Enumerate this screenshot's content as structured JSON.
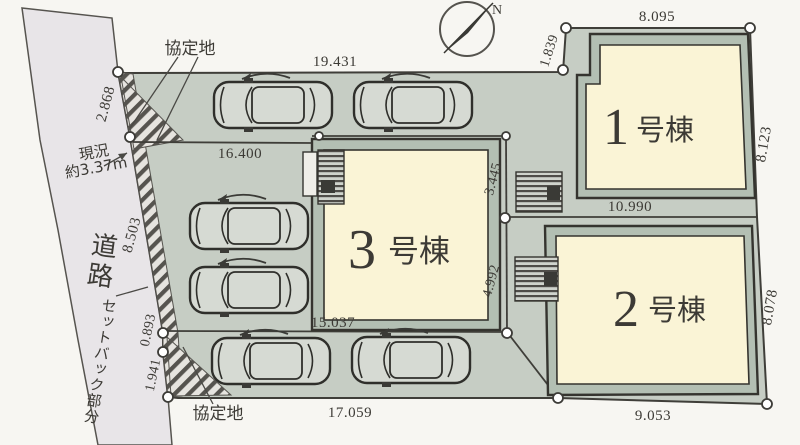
{
  "compass": {
    "north_label": "N"
  },
  "road": {
    "name": "道路",
    "width_note_line1": "現況",
    "width_note_line2": "約3.37m",
    "setback_label": "セットバック部分"
  },
  "agreement_area": {
    "top_label": "協定地",
    "bottom_label": "協定地"
  },
  "buildings": [
    {
      "number": "1",
      "suffix": "号棟"
    },
    {
      "number": "2",
      "suffix": "号棟"
    },
    {
      "number": "3",
      "suffix": "号棟"
    }
  ],
  "dimensions": {
    "top_width": "19.431",
    "middle_width": "16.400",
    "lot3_south": "15.037",
    "bottom_width": "17.059",
    "lot1_north": "8.095",
    "lot1_step": "1.839",
    "lot1_east": "8.123",
    "lot1_lot2_boundary": "10.990",
    "lot2_east": "8.078",
    "lot2_south": "9.053",
    "road_north": "2.868",
    "road_middle": "8.503",
    "road_seg_upper": "0.893",
    "road_seg_lower": "1.941",
    "lot1_approach": "3.445",
    "lot2_approach": "4.992"
  },
  "colors": {
    "ground": "#c6cdc4",
    "road": "#e8e5e8",
    "building_fill": "#faf4d6",
    "building_band": "#b3bfb3",
    "line": "#45443f"
  }
}
